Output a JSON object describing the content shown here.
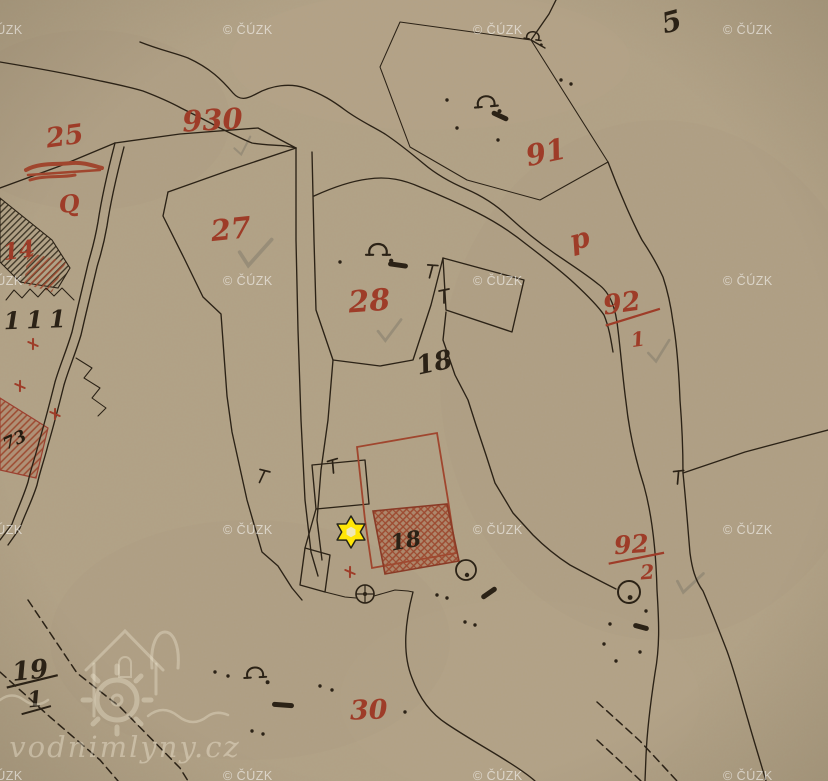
{
  "map": {
    "type": "historical-cadastral-map-scan",
    "paper_color": "#b2a184",
    "ink_color": "#2b2216",
    "red_color": "#9e3c28",
    "pencil_color": "#8b8270",
    "labels": [
      {
        "name": "parcel-label-25",
        "text": "25",
        "x": 66,
        "y": 145,
        "size": 27,
        "color": "red",
        "rot": -8
      },
      {
        "name": "parcel-label-930",
        "text": "930",
        "x": 213,
        "y": 130,
        "size": 29,
        "color": "red",
        "rot": -3
      },
      {
        "name": "red-q-mark",
        "text": "Q",
        "x": 70,
        "y": 212,
        "size": 24,
        "color": "red",
        "rot": -6
      },
      {
        "name": "parcel-label-27",
        "text": "27",
        "x": 232,
        "y": 239,
        "size": 29,
        "color": "red",
        "rot": -6
      },
      {
        "name": "parcel-label-28",
        "text": "28",
        "x": 370,
        "y": 311,
        "size": 30,
        "color": "red",
        "rot": -4
      },
      {
        "name": "parcel-label-91",
        "text": "91",
        "x": 548,
        "y": 162,
        "size": 29,
        "color": "red",
        "rot": -12
      },
      {
        "name": "red-letter-p",
        "text": "p",
        "x": 582,
        "y": 248,
        "size": 28,
        "color": "red",
        "rot": -15
      },
      {
        "name": "parcel-label-30",
        "text": "30",
        "x": 369,
        "y": 719,
        "size": 27,
        "color": "red",
        "rot": -2
      },
      {
        "name": "parcel-label-14",
        "text": "14",
        "x": 20,
        "y": 258,
        "size": 23,
        "color": "red",
        "rot": -8
      },
      {
        "name": "parcel-label-5",
        "text": "5",
        "x": 674,
        "y": 31,
        "size": 28,
        "color": "black",
        "rot": -15
      },
      {
        "name": "house-label-111",
        "text": "111",
        "x": 38,
        "y": 328,
        "size": 24,
        "color": "black",
        "rot": -2,
        "spacing": 6
      },
      {
        "name": "parcel-label-18",
        "text": "18",
        "x": 436,
        "y": 371,
        "size": 26,
        "color": "black",
        "rot": -12
      },
      {
        "name": "building-label-18",
        "text": "18",
        "x": 407,
        "y": 548,
        "size": 22,
        "color": "black",
        "rot": -10
      },
      {
        "name": "house-label-73",
        "text": "73",
        "x": 17,
        "y": 445,
        "size": 17,
        "color": "dark",
        "rot": -25
      }
    ],
    "fractions": [
      {
        "name": "parcel-label-92-1",
        "num": "92",
        "den": "1",
        "cx": 623,
        "numY": 312,
        "numSize": 27,
        "denSize": 20,
        "lx1": 604,
        "ly1": 323,
        "lx2": 660,
        "ly2": 314,
        "dx": 634,
        "dy": 348,
        "color": "red",
        "rot": -8
      },
      {
        "name": "parcel-label-92-2",
        "num": "92",
        "den": "2",
        "cx": 632,
        "numY": 553,
        "numSize": 25,
        "denSize": 20,
        "lx1": 608,
        "ly1": 562,
        "lx2": 664,
        "ly2": 555,
        "dx": 646,
        "dy": 580,
        "color": "red",
        "rot": -4
      },
      {
        "name": "parcel-label-19-1",
        "num": "19",
        "den": "1",
        "cx": 31,
        "numY": 679,
        "numSize": 26,
        "denSize": 22,
        "lx1": 6,
        "ly1": 685,
        "lx2": 58,
        "ly2": 678,
        "dx": 33,
        "dy": 707,
        "color": "black",
        "rot": -6,
        "l2": [
          18,
          713,
          48,
          708
        ]
      }
    ],
    "meadow_symbols": [
      {
        "x": 486,
        "y": 102,
        "s": 1.15,
        "rot": -5,
        "kind": "horseshoe",
        "name": "meadow-symbol"
      },
      {
        "x": 378,
        "y": 250,
        "s": 1.2,
        "rot": 0,
        "kind": "horseshoe",
        "name": "meadow-symbol"
      },
      {
        "x": 533,
        "y": 36,
        "s": 0.85,
        "rot": 8,
        "kind": "horseshoe",
        "name": "meadow-symbol"
      },
      {
        "x": 255,
        "y": 673,
        "s": 1.1,
        "rot": -3,
        "kind": "horseshoe",
        "name": "meadow-symbol"
      },
      {
        "x": 629,
        "y": 592,
        "s": 1.1,
        "rot": 0,
        "kind": "circle",
        "name": "pasture-symbol"
      },
      {
        "x": 466,
        "y": 570,
        "s": 1.0,
        "rot": 0,
        "kind": "circle",
        "name": "pasture-symbol"
      },
      {
        "x": 365,
        "y": 594,
        "s": 1.0,
        "rot": 0,
        "kind": "wheel",
        "name": "mill-wheel-symbol"
      }
    ],
    "dots": [
      [
        447,
        100
      ],
      [
        457,
        128
      ],
      [
        340,
        262
      ],
      [
        498,
        140
      ],
      [
        561,
        80
      ],
      [
        571,
        84
      ],
      [
        215,
        672
      ],
      [
        228,
        676
      ],
      [
        320,
        686
      ],
      [
        332,
        690
      ],
      [
        252,
        731
      ],
      [
        263,
        734
      ],
      [
        405,
        712
      ],
      [
        610,
        624
      ],
      [
        646,
        611
      ],
      [
        640,
        652
      ],
      [
        616,
        661
      ],
      [
        604,
        644
      ],
      [
        437,
        595
      ],
      [
        447,
        598
      ],
      [
        465,
        622
      ],
      [
        475,
        625
      ]
    ],
    "ink_blobs": [
      [
        500,
        116,
        13,
        25
      ],
      [
        398,
        265,
        15,
        8
      ],
      [
        283,
        705,
        17,
        4
      ],
      [
        641,
        627,
        11,
        15
      ],
      [
        489,
        593,
        13,
        -35
      ]
    ],
    "boundary_tees": [
      [
        262,
        477,
        25
      ],
      [
        333,
        467,
        -5
      ],
      [
        678,
        478,
        5
      ],
      [
        431,
        272,
        15
      ],
      [
        444,
        297,
        0
      ]
    ],
    "red_crosses": [
      [
        33,
        344
      ],
      [
        20,
        386
      ],
      [
        55,
        414
      ],
      [
        350,
        572
      ]
    ],
    "pencil_checks": [
      [
        234,
        146,
        0.8,
        -10
      ],
      [
        240,
        248,
        1.4,
        5
      ],
      [
        378,
        328,
        1.05,
        0
      ],
      [
        648,
        350,
        1.0,
        -5
      ],
      [
        678,
        578,
        1.1,
        10
      ]
    ]
  },
  "watermarks": {
    "cuzk_text": "© ČÚZK",
    "cuzk_positions": [
      [
        -27,
        34
      ],
      [
        223,
        34
      ],
      [
        473,
        34
      ],
      [
        723,
        34
      ],
      [
        -27,
        285
      ],
      [
        223,
        285
      ],
      [
        473,
        285
      ],
      [
        723,
        285
      ],
      [
        -27,
        534
      ],
      [
        223,
        534
      ],
      [
        473,
        534
      ],
      [
        723,
        534
      ],
      [
        -27,
        780
      ],
      [
        223,
        780
      ],
      [
        473,
        780
      ],
      [
        723,
        780
      ]
    ],
    "site_text": "vodnimlyny.cz"
  },
  "marker": {
    "shape": "six-pointed-star",
    "x": 351,
    "y": 532,
    "outer_radius": 16,
    "inner_radius": 9.3,
    "hole_radius": 5.2,
    "fill": "#ffe607",
    "outline": "#23231a",
    "hole_fill": "#eee8c2"
  }
}
